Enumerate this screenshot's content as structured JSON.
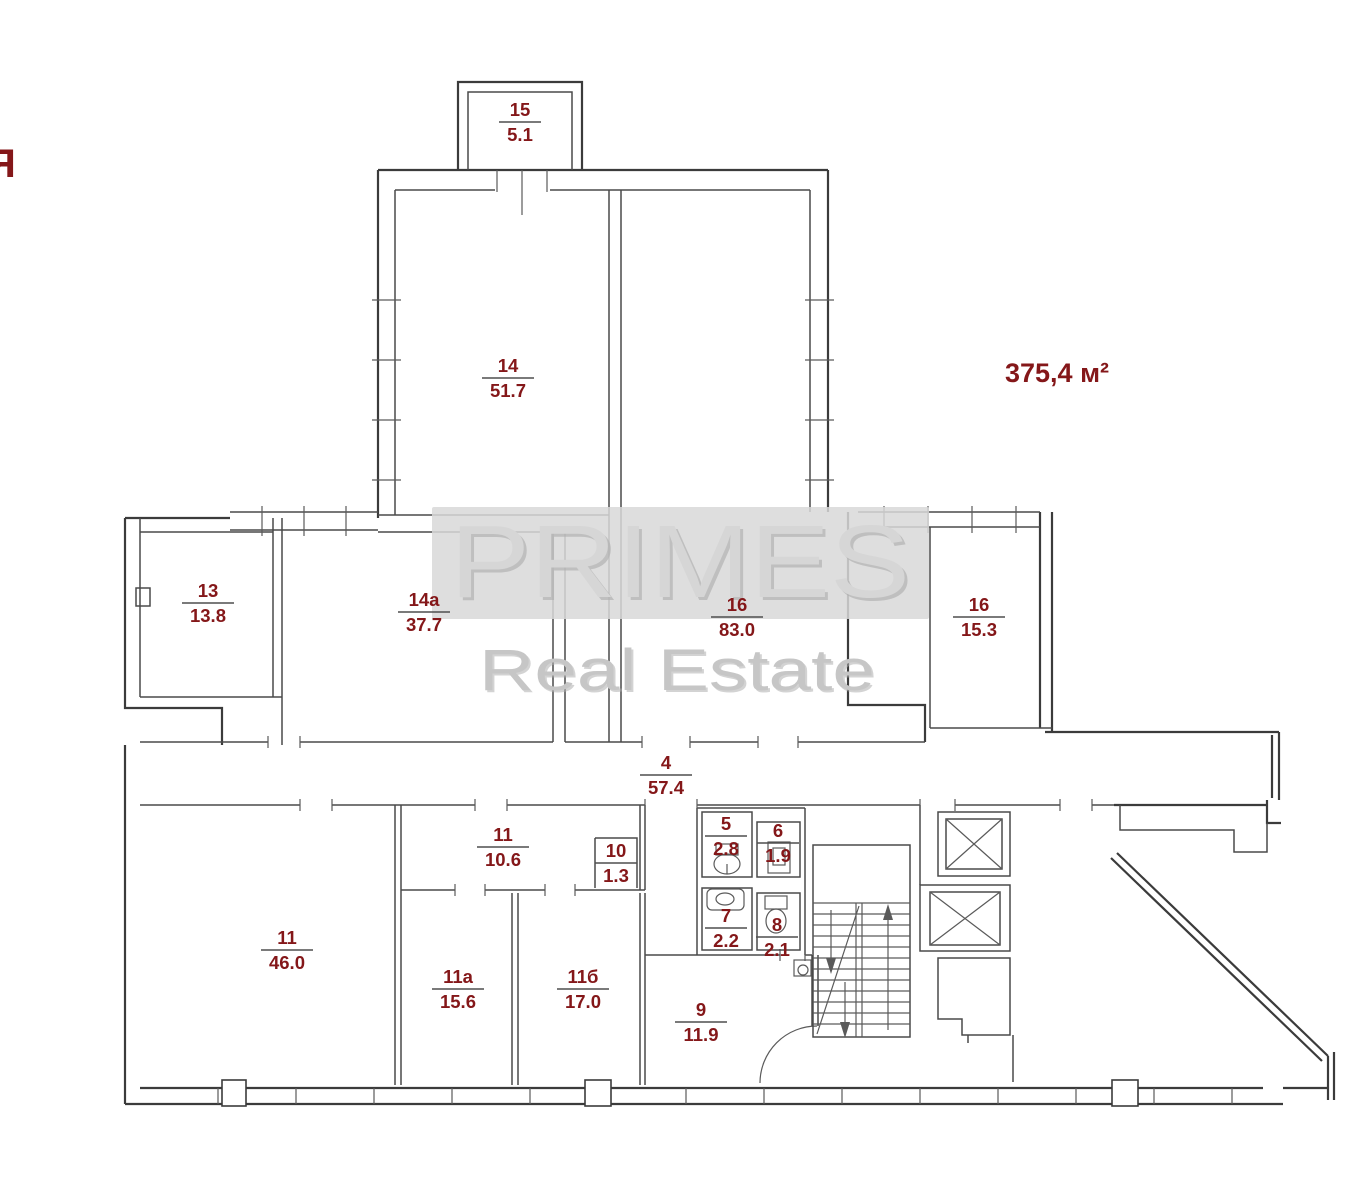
{
  "colors": {
    "label": "#841719",
    "wall": "#3b3b3b",
    "wall_secondary": "#4a4a4a",
    "watermark_band": "#d8d8d8",
    "watermark_text": "#d6d6d6",
    "watermark_shadow": "#b0b0b0"
  },
  "corner_letter": "Я",
  "total_area": {
    "text": "375,4 м²"
  },
  "watermark": {
    "line1": "PRIMES",
    "line2": "Real Estate"
  },
  "rooms": [
    {
      "number": "15",
      "area": "5.1",
      "x": 520,
      "y": 122
    },
    {
      "number": "14",
      "area": "51.7",
      "x": 508,
      "y": 378
    },
    {
      "number": "13",
      "area": "13.8",
      "x": 208,
      "y": 603
    },
    {
      "number": "14a",
      "area": "37.7",
      "x": 424,
      "y": 612
    },
    {
      "number": "16",
      "area": "83.0",
      "x": 737,
      "y": 617
    },
    {
      "number": "16",
      "area": "15.3",
      "x": 979,
      "y": 617
    },
    {
      "number": "4",
      "area": "57.4",
      "x": 666,
      "y": 775
    },
    {
      "number": "5",
      "area": "2.8",
      "x": 726,
      "y": 836
    },
    {
      "number": "6",
      "area": "1.9",
      "x": 778,
      "y": 843
    },
    {
      "number": "11",
      "area": "10.6",
      "x": 503,
      "y": 847
    },
    {
      "number": "10",
      "area": "1.3",
      "x": 616,
      "y": 863
    },
    {
      "number": "7",
      "area": "2.2",
      "x": 726,
      "y": 928
    },
    {
      "number": "8",
      "area": "2.1",
      "x": 777,
      "y": 937
    },
    {
      "number": "11",
      "area": "46.0",
      "x": 287,
      "y": 950
    },
    {
      "number": "11a",
      "area": "15.6",
      "x": 458,
      "y": 989
    },
    {
      "number": "11б",
      "area": "17.0",
      "x": 583,
      "y": 989
    },
    {
      "number": "9",
      "area": "11.9",
      "x": 701,
      "y": 1022
    }
  ]
}
